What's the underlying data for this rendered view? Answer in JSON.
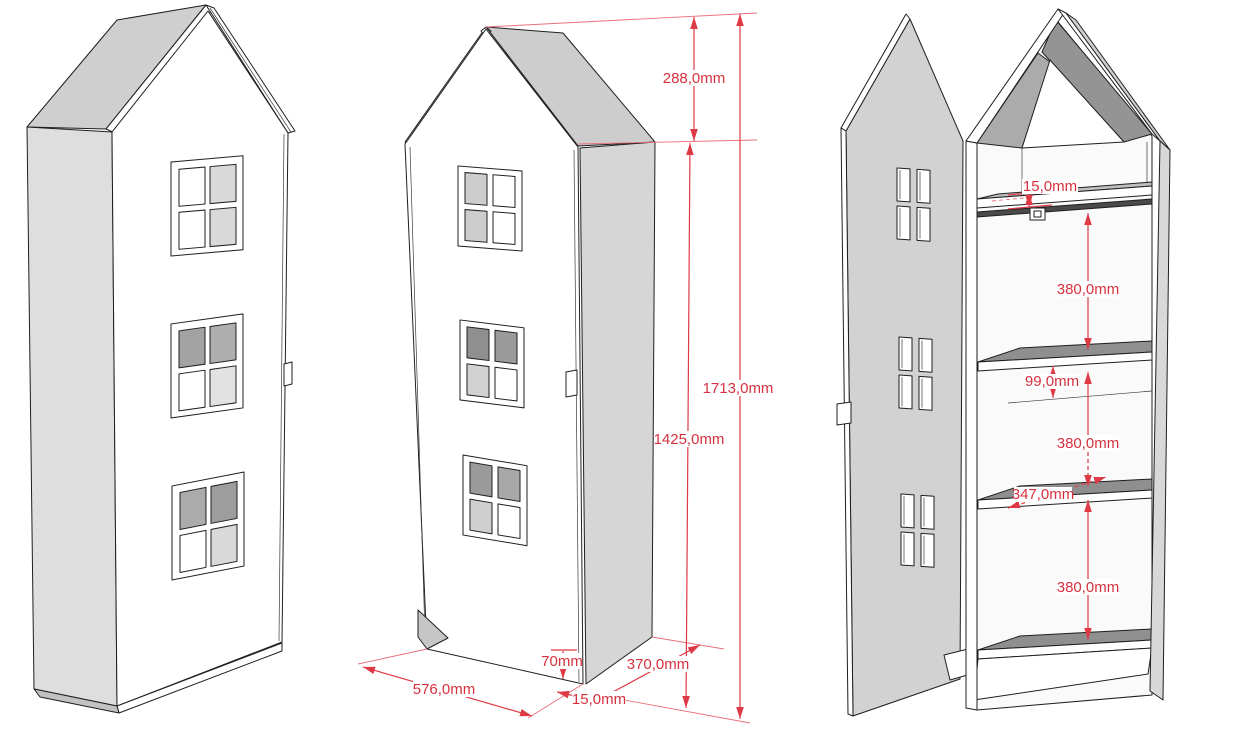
{
  "figure": {
    "type": "furniture technical drawing",
    "subject": "house-shaped kids cabinet wardrobe shown in three perspective views",
    "views": [
      {
        "id": "closed",
        "name": "closed cabinet, front-left perspective"
      },
      {
        "id": "dimensioned",
        "name": "closed cabinet, front-right perspective with overall dimensions"
      },
      {
        "id": "open",
        "name": "open cabinet with door swung open and interior shelf dimensions"
      }
    ]
  },
  "colors": {
    "background": "#ffffff",
    "outline": "#1f1f1f",
    "dimension_red": "#dd3a46",
    "dimension_text_red": "#d6313e",
    "panel_light_gray": "#d6d6d6",
    "roof_gray": "#cdcdcd",
    "shelf_dark_gray": "#8f8f8f"
  },
  "dimensions": {
    "overall": {
      "roof_height": "288,0mm",
      "total_height": "1713,0mm",
      "body_height": "1425,0mm",
      "plinth_height": "70mm",
      "front_width": "576,0mm",
      "door_thickness": "15,0mm",
      "side_depth": "370,0mm"
    },
    "interior": {
      "top_panel_thickness": "15,0mm",
      "upper_section_height": "380,0mm",
      "rail_drop": "99,0mm",
      "middle_section_height": "380,0mm",
      "shelf_depth": "347,0mm",
      "lower_section_height": "380,0mm"
    }
  }
}
